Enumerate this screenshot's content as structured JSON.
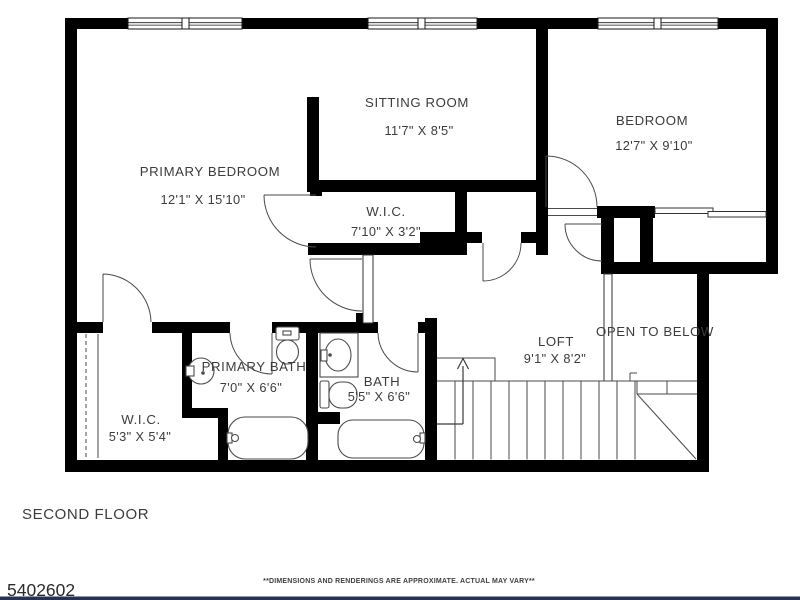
{
  "document": {
    "floor_label": "SECOND FLOOR",
    "listing_number": "5402602",
    "disclaimer": "**DIMENSIONS AND RENDERINGS ARE APPROXIMATE. ACTUAL MAY VARY**"
  },
  "rooms": {
    "primary_bedroom": {
      "name": "PRIMARY BEDROOM",
      "dims": "12'1\" X 15'10\""
    },
    "sitting_room": {
      "name": "SITTING ROOM",
      "dims": "11'7\" X 8'5\""
    },
    "bedroom": {
      "name": "BEDROOM",
      "dims": "12'7\" X 9'10\""
    },
    "hall_wic": {
      "name": "W.I.C.",
      "dims": "7'10\" X 3'2\""
    },
    "loft": {
      "name": "LOFT",
      "dims": "9'1\" X 8'2\""
    },
    "primary_bath": {
      "name": "PRIMARY BATH",
      "dims": "7'0\" X 6'6\""
    },
    "bath": {
      "name": "BATH",
      "dims": "5'5\" X 6'6\""
    },
    "primary_wic": {
      "name": "W.I.C.",
      "dims": "5'3\" X 5'4\""
    }
  },
  "annotations": {
    "open_to_below": "OPEN TO BELOW"
  },
  "colors": {
    "wall": "#000000",
    "thin_line": "#4a4a4a",
    "text": "#3c3c3c",
    "footer_bar": "#233258",
    "background": "#ffffff"
  }
}
